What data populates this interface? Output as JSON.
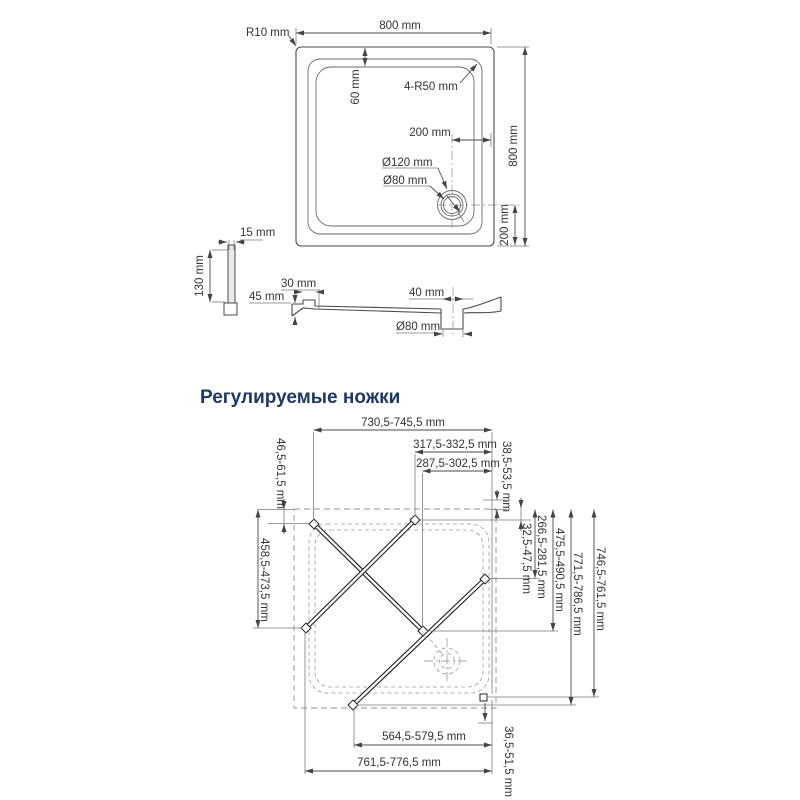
{
  "colors": {
    "heading": "#1f3864",
    "line": "#4a4a4a",
    "dashed": "#909090",
    "text": "#333333",
    "background": "#ffffff"
  },
  "top_view": {
    "width": "800 mm",
    "height": "800 mm",
    "corner_radius": "R10 mm",
    "inner_corner_radius": "4-R50 mm",
    "rim_width": "60 mm",
    "drain_offset_x": "200 mm",
    "drain_offset_y": "200 mm",
    "drain_outer_diameter": "Ø120 mm",
    "drain_inner_diameter": "Ø80 mm"
  },
  "side_view": {
    "thickness": "15 mm",
    "height": "130 mm"
  },
  "section_view": {
    "ledge_width": "30 mm",
    "edge_height": "45 mm",
    "drain_offset": "40 mm",
    "drain_diameter": "Ø80 mm"
  },
  "legs": {
    "heading": "Регулируемые ножки",
    "top_span": "730,5-745,5 mm",
    "top_span_mid": "317,5-332,5 mm",
    "top_span_inner": "287,5-302,5 mm",
    "top_left_offset": "46,5-61,5 mm",
    "top_right_offset": "38,5-53,5 mm",
    "right_offset_small": "32,5-47,5 mm",
    "right_span_1": "266,5-281,5 mm",
    "right_span_2": "475,5-490,5 mm",
    "right_span_3": "771,5-786,5 mm",
    "right_span_4": "746,5-761,5 mm",
    "left_span": "458,5-473,5 mm",
    "bottom_span_inner": "564,5-579,5 mm",
    "bottom_span": "761,5-776,5 mm",
    "bottom_right_offset": "36,5-51,5 mm"
  }
}
